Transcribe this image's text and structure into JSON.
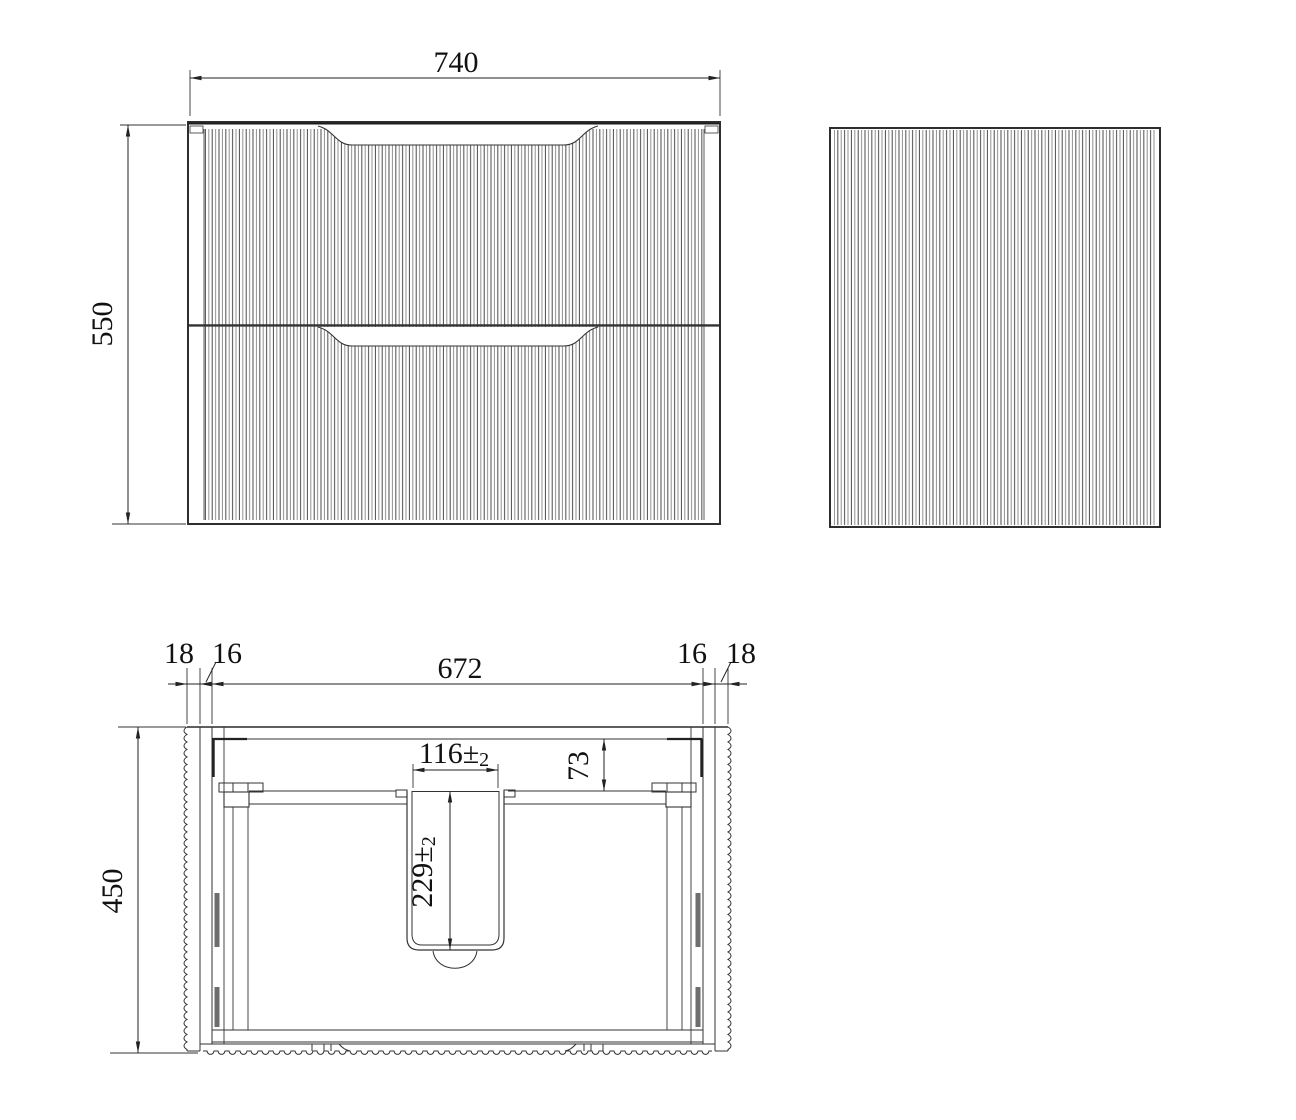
{
  "drawing": {
    "type": "vanity-cabinet-technical-drawing",
    "views": {
      "front_view": {
        "width_label": "740",
        "height_label": "550"
      },
      "side_view": {},
      "plan_view": {
        "panel_left": "18",
        "gap_left": "16",
        "inner_width": "672",
        "gap_right": "16",
        "panel_right": "18",
        "depth": "450",
        "basin_cutout_width": "116±",
        "basin_cutout_width_tol": "2",
        "basin_back_offset": "73",
        "basin_cutout_depth": "229±",
        "basin_cutout_depth_tol": "2"
      }
    },
    "colors": {
      "line": "#2a2a2a",
      "dimension": "#222222",
      "flute_dark": "#4a4a4a",
      "flute_light": "#8f8f8f",
      "background": "#ffffff"
    }
  }
}
